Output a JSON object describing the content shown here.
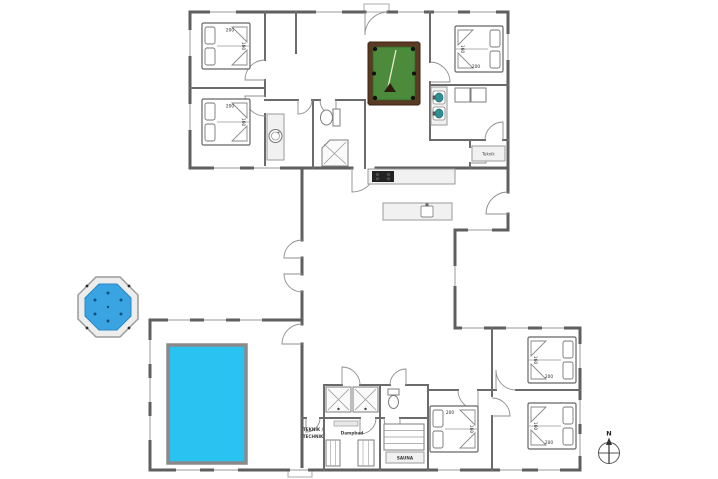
{
  "labels": {
    "bed_length": "200",
    "bed_width": "160"
  },
  "rooms": {
    "teknik_small": "Teknik",
    "teknik_line1": "TEKNIK /",
    "teknik_line2": "TECHNIK",
    "steam_bath": "Dampbad",
    "sauna": "SAUNA"
  },
  "compass": {
    "north": "N"
  },
  "colors": {
    "wall": "#5f5f5f",
    "pool_water": "#29c2f1",
    "hot_tub_water": "#3aa4e3",
    "billiard_felt": "#4b8b3b",
    "billiard_frame": "#5a3a22",
    "sink": "#2e8f96",
    "cooktop": "#222222",
    "fixture_fill": "#f1f1f1"
  }
}
